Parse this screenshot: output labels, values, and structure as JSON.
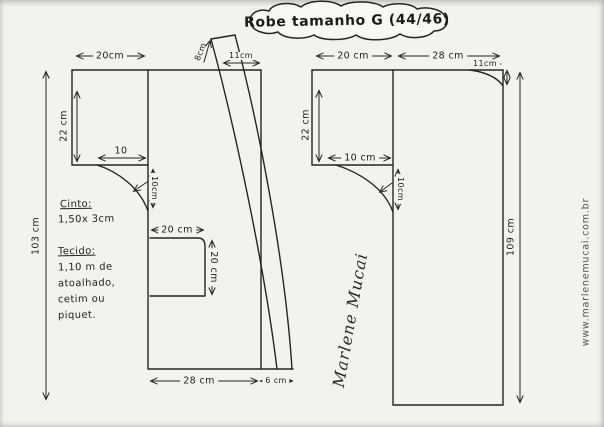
{
  "title": "Robe tamanho G (44/46)",
  "colors": {
    "paper": "#f3f2ec",
    "ink": "#26261f"
  },
  "left_piece": {
    "labels": {
      "top_width": "20cm",
      "band_width": "8cm",
      "shoulder_width": "11cm",
      "upper_height": "22 cm",
      "chest_inset": "10",
      "armhole_depth": "10cm",
      "total_height": "103 cm",
      "pocket_width": "20 cm",
      "pocket_height": "20 cm",
      "bottom_width": "28 cm",
      "band_bottom_width": "6 cm"
    }
  },
  "right_piece": {
    "labels": {
      "top_left_width": "20 cm",
      "top_right_width": "28 cm",
      "neck_width": "11cm",
      "upper_height": "22 cm",
      "chest_inset": "10 cm",
      "armhole_depth": "10cm",
      "total_height": "109 cm"
    }
  },
  "notes": {
    "belt_heading": "Cinto:",
    "belt_value": "1,50x 3cm",
    "fabric_heading": "Tecido:",
    "fabric_line1": "1,10 m de",
    "fabric_line2": "atoalhado,",
    "fabric_line3": "cetim ou",
    "fabric_line4": "piquet."
  },
  "signature": "Marlene Mucai",
  "watermark": "www.marlenemucai.com.br"
}
